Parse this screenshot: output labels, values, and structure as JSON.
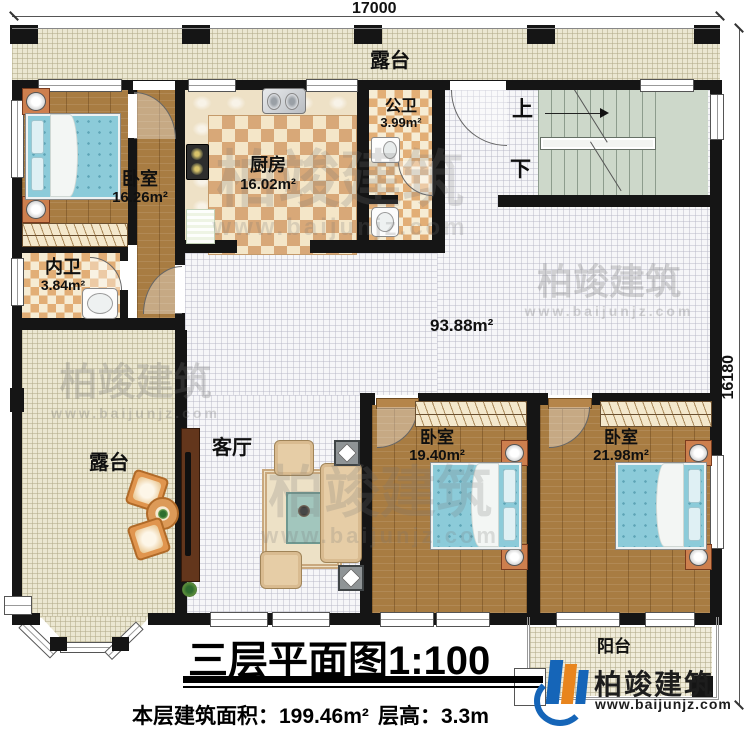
{
  "dims": {
    "top": "17000",
    "right": "16180"
  },
  "labels": {
    "terrace_top": "露台",
    "terrace_left": "露台",
    "balcony": "阳台",
    "living": "客厅",
    "open_area": "93.88m²",
    "up": "上",
    "down": "下"
  },
  "rooms": {
    "bedroom_tl": {
      "name": "卧室",
      "area": "16.26m²"
    },
    "kitchen": {
      "name": "厨房",
      "area": "16.02m²"
    },
    "public_bath": {
      "name": "公卫",
      "area": "3.99m²"
    },
    "private_bath": {
      "name": "内卫",
      "area": "3.84m²"
    },
    "bedroom_s": {
      "name": "卧室",
      "area": "19.40m²"
    },
    "bedroom_l": {
      "name": "卧室",
      "area": "21.98m²"
    }
  },
  "title": {
    "text": "三层平面图1:100",
    "floor_area_label": "本层建筑面积：",
    "floor_area_value": "199.46m²",
    "story_height_label": "层高：",
    "story_height_value": "3.3m"
  },
  "brand": {
    "name": "柏竣建筑",
    "url": "www.baijunjz.com"
  }
}
